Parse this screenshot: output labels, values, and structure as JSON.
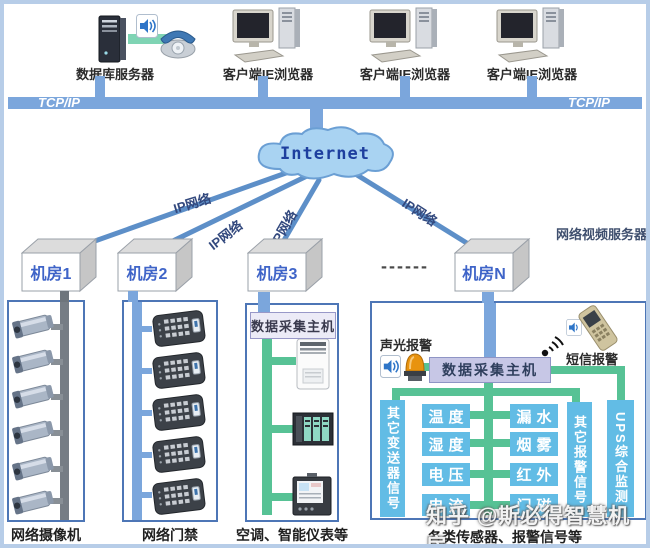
{
  "top": {
    "db_server_label": "数据库服务器",
    "client_labels": [
      "客户端IE浏览器",
      "客户端IE浏览器",
      "客户端IE浏览器"
    ],
    "tcpip_left": "TCP/IP",
    "tcpip_right": "TCP/IP"
  },
  "network": {
    "internet_label": "Internet",
    "ip_labels": [
      "IP网络",
      "IP网络",
      "IP网络",
      "IP网络"
    ],
    "video_server_label": "网络视频服务器",
    "rooms": [
      "机房1",
      "机房2",
      "机房3",
      "机房N"
    ],
    "dashes": "------"
  },
  "panels": {
    "cameras": {
      "label": "网络摄像机"
    },
    "access": {
      "label": "网络门禁"
    },
    "collect": {
      "header": "数据采集主机",
      "label": "空调、智能仪表等"
    },
    "sensors": {
      "sound_light_label": "声光报警",
      "sms_label": "短信报警",
      "host": "数据采集主机",
      "left_column": [
        "温度",
        "湿度",
        "电压",
        "电流"
      ],
      "right_column": [
        "漏水",
        "烟雾",
        "红外",
        "门磁"
      ],
      "left_tall": "其它变送器信号",
      "right_tall": "其它报警信号",
      "ups": "UPS综合监测",
      "label": "各类传感器、报警信号等"
    }
  },
  "watermark": "知乎 @斯必得智慧机房",
  "colors": {
    "bus_blue": "#7ba6dc",
    "line_blue": "#5d8fc8",
    "panel_border": "#4d76b6",
    "green_link": "#57c295",
    "sensor_blue": "#62bce5",
    "host_lavender": "#c7c7e6",
    "cloud_fill": "#a9d3f2",
    "room_text": "#3f64c8"
  }
}
